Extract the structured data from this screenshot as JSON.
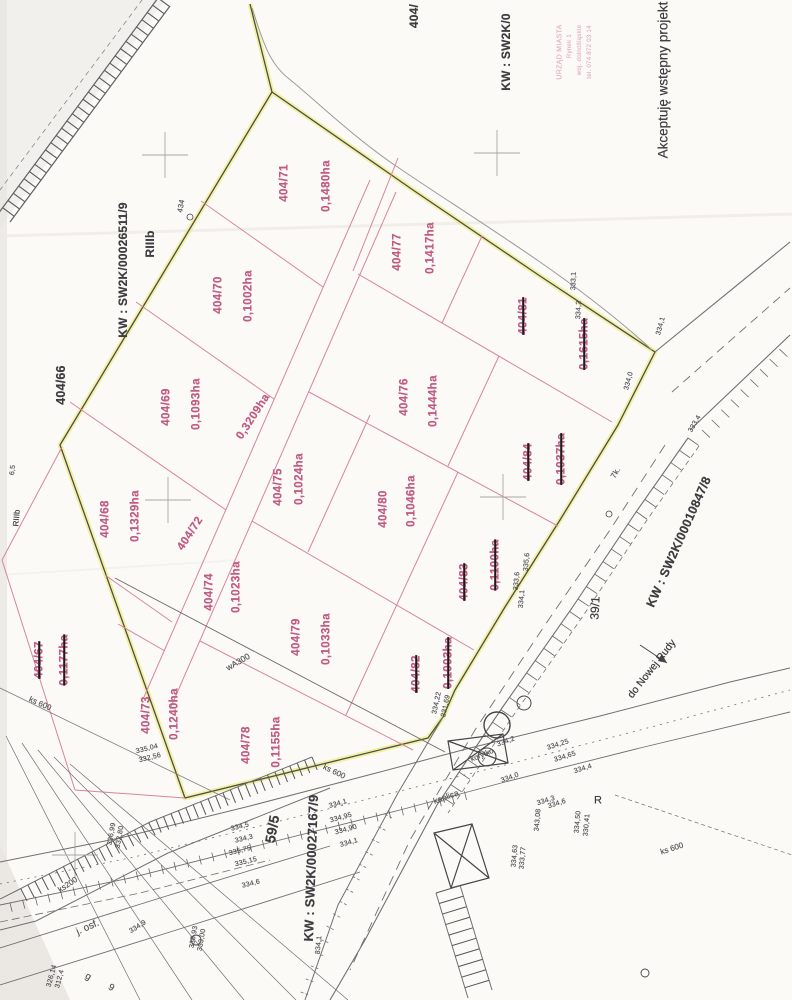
{
  "document_type": "cadastral parcel map scan (wstępny projekt podziału)",
  "approval_note": "Akceptuję wstępny projekt",
  "soil_class": "RIIIb",
  "land_register_numbers": [
    "KW : SW2K/00026511/9",
    "KW : SW2K/00010847/8",
    "KW : SW2K/00027167/9",
    "KW : SW2K/0"
  ],
  "stamp": {
    "lines": [
      "URZĄD MIASTA",
      "Rynek 1",
      "woj. dolnośląskie",
      "tel. 074 872 03 14"
    ]
  },
  "roads": {
    "destination_label": "do Nowej Rudy",
    "surface_label": "j. osf.",
    "road_parcels": [
      "59/5",
      "39/1"
    ]
  },
  "utilities": [
    "wA300",
    "ks 600",
    "ks200"
  ],
  "colors": {
    "parcel_pink": "#c05c84",
    "parcel_line": "#d884a0",
    "boundary_highlight": "#e6e63e",
    "ink": "#3e3e42",
    "paper": "#fbfaf6"
  },
  "parcels": [
    {
      "id": "404/71",
      "area": "0,1480ha",
      "crossed_out": false
    },
    {
      "id": "404/77",
      "area": "0,1417ha",
      "crossed_out": false
    },
    {
      "id": "404/70",
      "area": "0,1002ha",
      "crossed_out": false
    },
    {
      "id": "404/69",
      "area": "0,1093ha",
      "crossed_out": false
    },
    {
      "id": "404/72",
      "area": "0,3209ha",
      "crossed_out": false
    },
    {
      "id": "404/68",
      "area": "0,1329ha",
      "crossed_out": false
    },
    {
      "id": "404/75",
      "area": "0,1024ha",
      "crossed_out": false
    },
    {
      "id": "404/76",
      "area": "0,1444ha",
      "crossed_out": false
    },
    {
      "id": "404/80",
      "area": "0,1046ha",
      "crossed_out": false
    },
    {
      "id": "404/81",
      "area": "0,1615ha",
      "crossed_out": true
    },
    {
      "id": "404/84",
      "area": "0,1037ha",
      "crossed_out": true
    },
    {
      "id": "404/83",
      "area": "0,1100ha",
      "crossed_out": true
    },
    {
      "id": "404/82",
      "area": "0,1003ha",
      "crossed_out": true
    },
    {
      "id": "404/74",
      "area": "0,1023ha",
      "crossed_out": false
    },
    {
      "id": "404/79",
      "area": "0,1033ha",
      "crossed_out": false
    },
    {
      "id": "404/73",
      "area": "0,1240ha",
      "crossed_out": false
    },
    {
      "id": "404/78",
      "area": "0,1155ha",
      "crossed_out": false
    },
    {
      "id": "404/67",
      "area": "0,1177ha",
      "crossed_out": true
    },
    {
      "id": "404/66",
      "area": "",
      "crossed_out": false
    }
  ],
  "labels": [
    {
      "n": "parcel-404-71",
      "t": "404/71",
      "x": 285,
      "y": 183,
      "r": -90,
      "c": "p"
    },
    {
      "n": "area-404-71",
      "t": "0,1480ha",
      "x": 327,
      "y": 186,
      "r": -90,
      "c": "p"
    },
    {
      "n": "parcel-404-77",
      "t": "404/77",
      "x": 398,
      "y": 252,
      "r": -90,
      "c": "p"
    },
    {
      "n": "area-404-77",
      "t": "0,1417ha",
      "x": 431,
      "y": 248,
      "r": -90,
      "c": "p"
    },
    {
      "n": "parcel-404-70",
      "t": "404/70",
      "x": 219,
      "y": 295,
      "r": -90,
      "c": "p"
    },
    {
      "n": "area-404-70",
      "t": "0,1002ha",
      "x": 249,
      "y": 296,
      "r": -90,
      "c": "p"
    },
    {
      "n": "parcel-404-69",
      "t": "404/69",
      "x": 167,
      "y": 407,
      "r": -90,
      "c": "p"
    },
    {
      "n": "area-404-69",
      "t": "0,1093ha",
      "x": 197,
      "y": 404,
      "r": -90,
      "c": "p"
    },
    {
      "n": "area-404-72",
      "t": "0,3209ha",
      "x": 254,
      "y": 417,
      "r": -57,
      "c": "p"
    },
    {
      "n": "parcel-404-72",
      "t": "404/72",
      "x": 191,
      "y": 534,
      "r": -57,
      "c": "p"
    },
    {
      "n": "parcel-404-68",
      "t": "404/68",
      "x": 106,
      "y": 519,
      "r": -90,
      "c": "p"
    },
    {
      "n": "area-404-68",
      "t": "0,1329ha",
      "x": 136,
      "y": 516,
      "r": -90,
      "c": "p"
    },
    {
      "n": "parcel-404-75",
      "t": "404/75",
      "x": 279,
      "y": 487,
      "r": -90,
      "c": "p"
    },
    {
      "n": "area-404-75",
      "t": "0,1024ha",
      "x": 300,
      "y": 479,
      "r": -90,
      "c": "p"
    },
    {
      "n": "parcel-404-76",
      "t": "404/76",
      "x": 405,
      "y": 397,
      "r": -90,
      "c": "p"
    },
    {
      "n": "area-404-76",
      "t": "0,1444ha",
      "x": 434,
      "y": 401,
      "r": -90,
      "c": "p"
    },
    {
      "n": "parcel-404-80",
      "t": "404/80",
      "x": 384,
      "y": 509,
      "r": -90,
      "c": "p"
    },
    {
      "n": "area-404-80",
      "t": "0,1046ha",
      "x": 412,
      "y": 501,
      "r": -90,
      "c": "p"
    },
    {
      "n": "parcel-404-81",
      "t": "404/81",
      "x": 524,
      "y": 316,
      "r": -90,
      "c": "p",
      "k": true
    },
    {
      "n": "area-404-81",
      "t": "0,1615ha",
      "x": 585,
      "y": 344,
      "r": -90,
      "c": "p",
      "k": true
    },
    {
      "n": "parcel-404-84",
      "t": "404/84",
      "x": 529,
      "y": 462,
      "r": -90,
      "c": "p",
      "k": true
    },
    {
      "n": "area-404-84",
      "t": "0,1037ha",
      "x": 562,
      "y": 459,
      "r": -90,
      "c": "p",
      "k": true
    },
    {
      "n": "parcel-404-83",
      "t": "404/83",
      "x": 465,
      "y": 582,
      "r": -90,
      "c": "p",
      "k": true
    },
    {
      "n": "area-404-83",
      "t": "0,1100ha",
      "x": 496,
      "y": 565,
      "r": -90,
      "c": "p",
      "k": true
    },
    {
      "n": "parcel-404-82",
      "t": "404/82",
      "x": 417,
      "y": 674,
      "r": -90,
      "c": "p",
      "k": true
    },
    {
      "n": "area-404-82",
      "t": "0,1003ha",
      "x": 449,
      "y": 663,
      "r": -90,
      "c": "p",
      "k": true
    },
    {
      "n": "parcel-404-74",
      "t": "404/74",
      "x": 210,
      "y": 592,
      "r": -90,
      "c": "p"
    },
    {
      "n": "area-404-74",
      "t": "0,1023ha",
      "x": 237,
      "y": 587,
      "r": -90,
      "c": "p"
    },
    {
      "n": "parcel-404-79",
      "t": "404/79",
      "x": 297,
      "y": 637,
      "r": -90,
      "c": "p"
    },
    {
      "n": "area-404-79",
      "t": "0,1033ha",
      "x": 327,
      "y": 639,
      "r": -90,
      "c": "p"
    },
    {
      "n": "parcel-404-73",
      "t": "404/73",
      "x": 147,
      "y": 715,
      "r": -90,
      "c": "p"
    },
    {
      "n": "area-404-73",
      "t": "0,1240ha",
      "x": 175,
      "y": 714,
      "r": -90,
      "c": "p"
    },
    {
      "n": "parcel-404-78",
      "t": "404/78",
      "x": 247,
      "y": 745,
      "r": -90,
      "c": "p"
    },
    {
      "n": "area-404-78",
      "t": "0,1155ha",
      "x": 277,
      "y": 742,
      "r": -90,
      "c": "p"
    },
    {
      "n": "parcel-404-67",
      "t": "404/67",
      "x": 40,
      "y": 660,
      "r": -90,
      "c": "p",
      "k": true
    },
    {
      "n": "area-404-67",
      "t": "0,1177ha",
      "x": 65,
      "y": 660,
      "r": -90,
      "c": "p",
      "k": true
    },
    {
      "n": "parcel-404-66",
      "t": "404/66",
      "x": 61,
      "y": 385,
      "r": -90,
      "c": "b",
      "s": 12.5
    },
    {
      "n": "soil-class-riiib",
      "t": "RIIIb",
      "x": 150,
      "y": 244,
      "r": -90,
      "c": "b",
      "s": 12
    },
    {
      "n": "kw-number-26511",
      "t": "KW : SW2K/00026511/9",
      "x": 123,
      "y": 270,
      "r": -90,
      "c": "b",
      "s": 12
    },
    {
      "n": "kw-number-10847",
      "t": "KW : SW2K/00010847/8",
      "x": 679,
      "y": 542,
      "r": -66,
      "c": "b",
      "s": 12.5
    },
    {
      "n": "kw-number-27167",
      "t": "KW : SW2K/00027167/9",
      "x": 311,
      "y": 868,
      "r": -88,
      "c": "b",
      "s": 13
    },
    {
      "n": "kw-number-truncated",
      "t": "KW : SW2K/0",
      "x": 506,
      "y": 52,
      "r": -90,
      "c": "b",
      "s": 12
    },
    {
      "n": "parcel-404-truncated",
      "t": "404/",
      "x": 414,
      "y": 16,
      "r": -90,
      "c": "b",
      "s": 12
    },
    {
      "n": "road-parcel-59-5",
      "t": "59/5",
      "x": 272,
      "y": 829,
      "r": -80,
      "c": "b",
      "s": 14
    },
    {
      "n": "road-parcel-39-1",
      "t": "39/1",
      "x": 595,
      "y": 608,
      "r": -87,
      "c": "bn",
      "s": 12
    },
    {
      "n": "road-destination",
      "t": "do Nowej Rudy",
      "x": 652,
      "y": 669,
      "r": -52,
      "c": "bn",
      "s": 10.5
    },
    {
      "n": "approval-note",
      "t": "Akceptuję wstępny projekt",
      "x": 663,
      "y": 80,
      "r": -90,
      "c": "bn",
      "s": 13.5
    },
    {
      "n": "soil-class-small",
      "t": "RIIIb",
      "x": 17,
      "y": 518,
      "r": -85,
      "c": "bn",
      "s": 8
    },
    {
      "n": "r-mark",
      "t": "R",
      "x": 598,
      "y": 801,
      "r": 0,
      "c": "bn",
      "s": 11
    },
    {
      "n": "road-surface",
      "t": "j. osf.",
      "x": 88,
      "y": 928,
      "r": -24,
      "c": "g",
      "s": 10
    },
    {
      "n": "utility-wa300",
      "t": "wA300",
      "x": 238,
      "y": 662,
      "r": -30,
      "c": "g",
      "s": 8.5
    },
    {
      "n": "utility-ks600-a",
      "t": "ks 600",
      "x": 40,
      "y": 704,
      "r": 24,
      "c": "g",
      "s": 8
    },
    {
      "n": "utility-ks600-b",
      "t": "ks 600",
      "x": 334,
      "y": 772,
      "r": 26,
      "c": "g",
      "s": 8
    },
    {
      "n": "utility-ks200",
      "t": "ks200",
      "x": 68,
      "y": 885,
      "r": -33,
      "c": "g",
      "s": 8
    },
    {
      "n": "utility-ks600-c",
      "t": "ks 600",
      "x": 672,
      "y": 849,
      "r": -18,
      "c": "g",
      "s": 8
    },
    {
      "n": "chapel-label",
      "t": "kaplica",
      "x": 446,
      "y": 797,
      "r": -20,
      "c": "g",
      "s": 8.5
    },
    {
      "n": "channel-label",
      "t": "korytko",
      "x": 482,
      "y": 755,
      "r": -22,
      "c": "g",
      "s": 7.5
    },
    {
      "n": "building-g",
      "t": "g",
      "x": 88,
      "y": 977,
      "r": 30,
      "c": "g",
      "s": 9.5
    },
    {
      "n": "building-9",
      "t": "9",
      "x": 111,
      "y": 988,
      "r": 30,
      "c": "g",
      "s": 9.5
    },
    {
      "n": "point-434",
      "t": "434",
      "x": 181,
      "y": 206,
      "r": -80,
      "c": "e",
      "s": 7.5
    },
    {
      "n": "mark-65",
      "t": "6,5",
      "x": 13,
      "y": 470,
      "r": -85,
      "c": "e",
      "s": 7
    },
    {
      "n": "mark-7k",
      "t": "7k.",
      "x": 616,
      "y": 473,
      "r": -60,
      "c": "e",
      "s": 8
    },
    {
      "n": "elev",
      "t": "333,1",
      "x": 574,
      "y": 281,
      "r": -88,
      "c": "e"
    },
    {
      "n": "elev",
      "t": "334,2",
      "x": 579,
      "y": 310,
      "r": -88,
      "c": "e"
    },
    {
      "n": "elev",
      "t": "334,1",
      "x": 661,
      "y": 326,
      "r": -75,
      "c": "e"
    },
    {
      "n": "elev",
      "t": "334,0",
      "x": 629,
      "y": 381,
      "r": -75,
      "c": "e"
    },
    {
      "n": "elev",
      "t": "333,4",
      "x": 695,
      "y": 424,
      "r": -60,
      "c": "e"
    },
    {
      "n": "elev",
      "t": "335,6",
      "x": 527,
      "y": 562,
      "r": -85,
      "c": "e"
    },
    {
      "n": "elev",
      "t": "333,6",
      "x": 517,
      "y": 581,
      "r": -85,
      "c": "e"
    },
    {
      "n": "elev",
      "t": "334,1",
      "x": 522,
      "y": 599,
      "r": -85,
      "c": "e"
    },
    {
      "n": "elev",
      "t": "334,25",
      "x": 558,
      "y": 745,
      "r": -18,
      "c": "e"
    },
    {
      "n": "elev",
      "t": "334,65",
      "x": 565,
      "y": 757,
      "r": -18,
      "c": "e"
    },
    {
      "n": "elev",
      "t": "334,4",
      "x": 583,
      "y": 769,
      "r": -18,
      "c": "e"
    },
    {
      "n": "elev",
      "t": "334,3",
      "x": 546,
      "y": 801,
      "r": -18,
      "c": "e"
    },
    {
      "n": "elev",
      "t": "334,6",
      "x": 557,
      "y": 804,
      "r": -18,
      "c": "e"
    },
    {
      "n": "elev",
      "t": "343,08",
      "x": 538,
      "y": 820,
      "r": -85,
      "c": "e"
    },
    {
      "n": "elev",
      "t": "334,50",
      "x": 578,
      "y": 822,
      "r": -85,
      "c": "e"
    },
    {
      "n": "elev",
      "t": "330,41",
      "x": 587,
      "y": 825,
      "r": -85,
      "c": "e"
    },
    {
      "n": "elev",
      "t": "334,63",
      "x": 515,
      "y": 856,
      "r": -85,
      "c": "e"
    },
    {
      "n": "elev",
      "t": "333,77",
      "x": 523,
      "y": 858,
      "r": -85,
      "c": "e"
    },
    {
      "n": "elev",
      "t": "334,2",
      "x": 506,
      "y": 742,
      "r": -20,
      "c": "e"
    },
    {
      "n": "elev",
      "t": "334,0",
      "x": 510,
      "y": 778,
      "r": -20,
      "c": "e"
    },
    {
      "n": "elev",
      "t": "334,5",
      "x": 240,
      "y": 827,
      "r": -14,
      "c": "e"
    },
    {
      "n": "elev",
      "t": "334,3",
      "x": 244,
      "y": 839,
      "r": -14,
      "c": "e"
    },
    {
      "n": "elev",
      "t": "335,75",
      "x": 240,
      "y": 851,
      "r": -14,
      "c": "e"
    },
    {
      "n": "elev",
      "t": "335,15",
      "x": 246,
      "y": 862,
      "r": -14,
      "c": "e"
    },
    {
      "n": "elev",
      "t": "334,6",
      "x": 251,
      "y": 884,
      "r": -14,
      "c": "e"
    },
    {
      "n": "elev",
      "t": "334,1",
      "x": 338,
      "y": 804,
      "r": -16,
      "c": "e"
    },
    {
      "n": "elev",
      "t": "334,95",
      "x": 341,
      "y": 818,
      "r": -16,
      "c": "e"
    },
    {
      "n": "elev",
      "t": "334,90",
      "x": 346,
      "y": 830,
      "r": -16,
      "c": "e"
    },
    {
      "n": "elev",
      "t": "334,1",
      "x": 349,
      "y": 843,
      "r": -16,
      "c": "e"
    },
    {
      "n": "elev",
      "t": "334,1",
      "x": 319,
      "y": 945,
      "r": -85,
      "c": "e"
    },
    {
      "n": "elev",
      "t": "334,22",
      "x": 437,
      "y": 703,
      "r": -78,
      "c": "e"
    },
    {
      "n": "elev",
      "t": "331,69",
      "x": 446,
      "y": 706,
      "r": -78,
      "c": "e"
    },
    {
      "n": "elev",
      "t": "335,04",
      "x": 147,
      "y": 749,
      "r": -14,
      "c": "e"
    },
    {
      "n": "elev",
      "t": "332,56",
      "x": 150,
      "y": 758,
      "r": -14,
      "c": "e"
    },
    {
      "n": "elev",
      "t": "336,99",
      "x": 112,
      "y": 834,
      "r": -80,
      "c": "e"
    },
    {
      "n": "elev",
      "t": "332,80",
      "x": 120,
      "y": 837,
      "r": -80,
      "c": "e"
    },
    {
      "n": "elev",
      "t": "336,93",
      "x": 194,
      "y": 937,
      "r": -80,
      "c": "e"
    },
    {
      "n": "elev",
      "t": "333,00",
      "x": 202,
      "y": 940,
      "r": -80,
      "c": "e"
    },
    {
      "n": "elev",
      "t": "326,14",
      "x": 52,
      "y": 976,
      "r": -75,
      "c": "e"
    },
    {
      "n": "elev",
      "t": "312,4",
      "x": 60,
      "y": 979,
      "r": -75,
      "c": "e"
    },
    {
      "n": "elev",
      "t": "334,9",
      "x": 138,
      "y": 927,
      "r": -33,
      "c": "e"
    },
    {
      "n": "stamp-line-1",
      "t": "URZĄD MIASTA",
      "x": 560,
      "y": 52,
      "r": -90,
      "c": "st",
      "s": 7
    },
    {
      "n": "stamp-line-2",
      "t": "Rynek 1",
      "x": 570,
      "y": 46,
      "r": -90,
      "c": "st",
      "s": 6
    },
    {
      "n": "stamp-line-3",
      "t": "woj. dolnośląskie",
      "x": 580,
      "y": 50,
      "r": -90,
      "c": "st",
      "s": 6
    },
    {
      "n": "stamp-line-4",
      "t": "tel. 074 872 03 14",
      "x": 590,
      "y": 52,
      "r": -90,
      "c": "st",
      "s": 6
    }
  ]
}
